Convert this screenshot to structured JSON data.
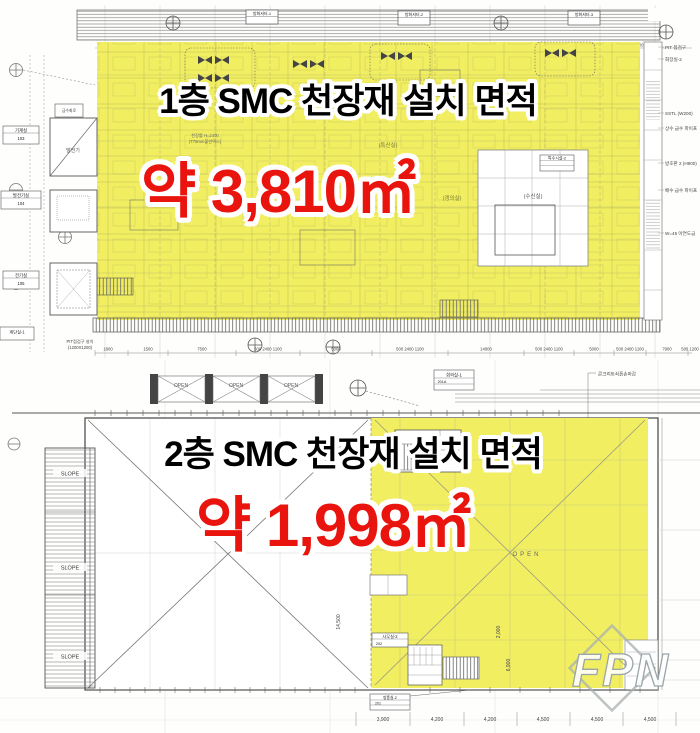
{
  "colors": {
    "highlight": "#f1ee62",
    "area_red": "#e9140e",
    "line": "#555555",
    "watermark_gray": "#9aa6aa"
  },
  "plan1": {
    "title": "1층 SMC 천장재 설치 면적",
    "area": "약 3,810㎡",
    "shutter_labels": [
      "방화셔터-1",
      "방화셔터-2",
      "방화셔터-3"
    ],
    "left_rooms": [
      {
        "name": "기계실",
        "no": "103"
      },
      {
        "name": "발전기실",
        "no": "104"
      },
      {
        "name": "전기실",
        "no": "105"
      }
    ],
    "pump_label": "급수회로",
    "generator_label": "발전기",
    "stair_label": "계단실-1",
    "pit_note": "PIT점검구 설치",
    "pit_note2": "(1200X1200)",
    "room_labels": [
      "(특신실)",
      "(갱의실)",
      "(수신실)"
    ],
    "ceiling_note": "천장틀 H=2400",
    "ceiling_note2": "(T75mm불연텍스)",
    "shutter_sign": "방화셔터표지",
    "special_box": "특수시설-2",
    "right_notes": [
      "PIT 점검구",
      "화장실-2",
      "SSTL (W200)",
      "상수 급수 파이프",
      "방호판 2 (H900)",
      "배수 급수 파이프",
      "W=45 아연도금"
    ],
    "top_dims": [
      "500",
      "5200",
      "10000",
      "5200",
      "500 1300",
      "10000",
      "5100",
      "8500",
      "500"
    ],
    "bottom_dims": [
      "1800",
      "1500",
      "7500",
      "500 2400 1100",
      "5000",
      "500 2400 1100",
      "14000",
      "500 2400 1100",
      "5000",
      "500 2400 1100",
      "7900",
      "500 1200"
    ]
  },
  "plan2": {
    "title": "2층 SMC 천장재 설치 면적",
    "area": "약 1,998㎡",
    "open_labels": [
      "OPEN",
      "OPEN",
      "OPEN"
    ],
    "area_open": "OPEN",
    "slope_labels": [
      "SLOPE",
      "SLOPE",
      "SLOPE"
    ],
    "meeting_room": "회의실-1",
    "meeting_room_no": "201A",
    "concrete_note": "콘크리트쇠흙손마감",
    "office": "사무실-2",
    "office_no": "202",
    "windbreak": "방풍실-2",
    "windbreak_no": "201",
    "dim_14500": "14,500",
    "dim_2000": "2,000",
    "dim_6900": "6,900",
    "bottom_dims": [
      "3,900",
      "4,200",
      "4,200",
      "4,500",
      "4,500",
      "4,500"
    ]
  },
  "watermark": "FPN"
}
